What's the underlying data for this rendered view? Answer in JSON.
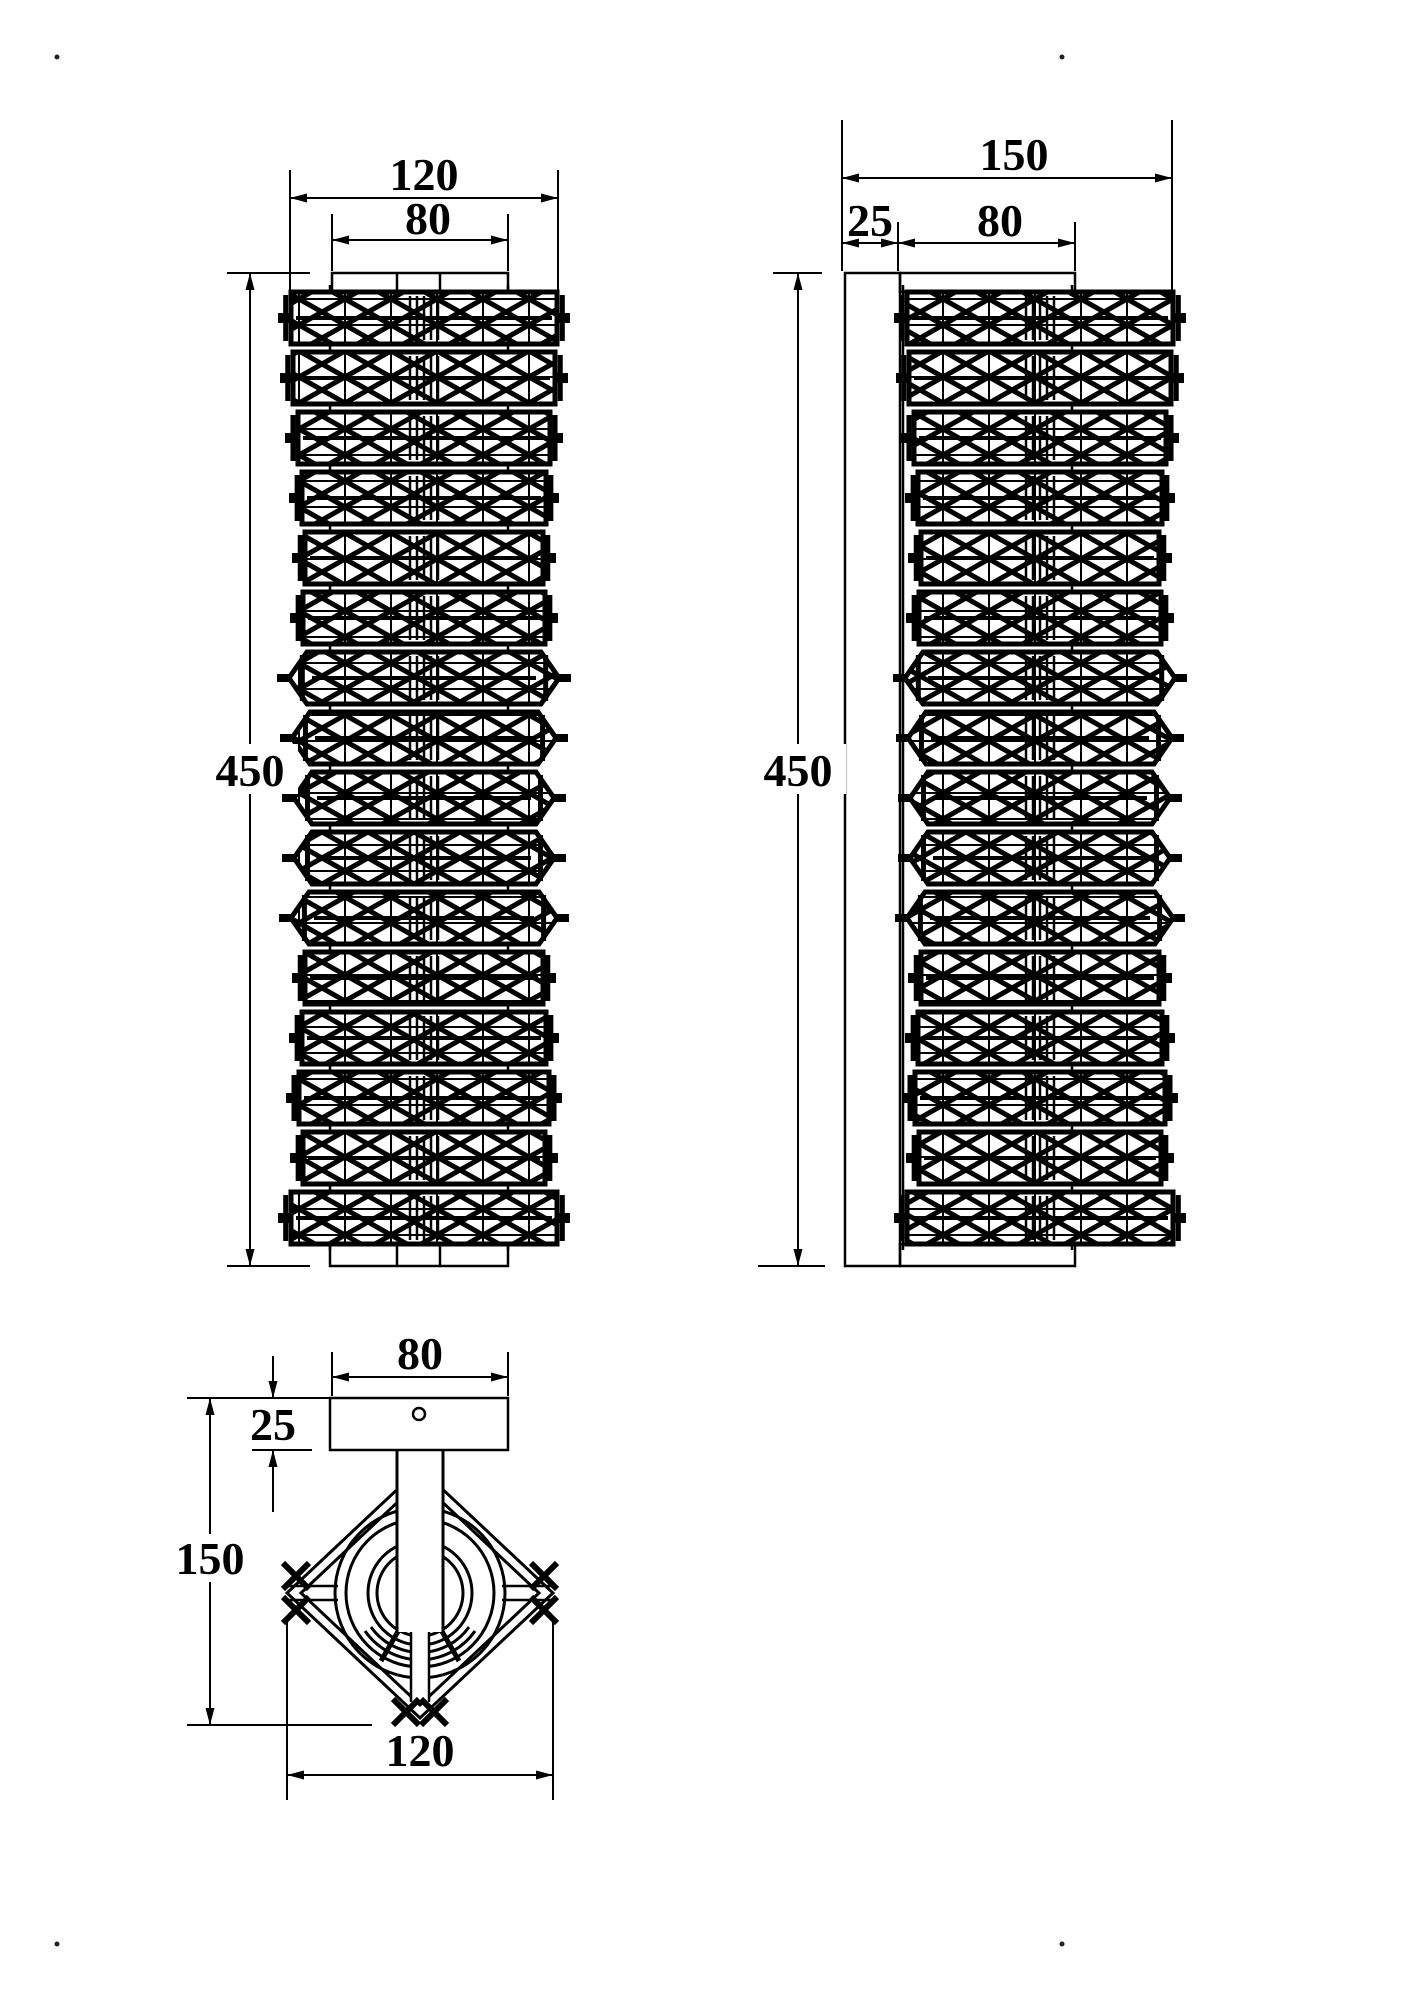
{
  "views": {
    "front": {
      "overall_width": "120",
      "canopy_width": "80",
      "height": "450"
    },
    "side": {
      "overall_depth": "150",
      "backplate_thickness": "25",
      "canopy_width": "80",
      "height": "450"
    },
    "top": {
      "canopy_width": "80",
      "canopy_depth": "25",
      "overall_depth": "150",
      "overall_width": "120"
    }
  },
  "colors": {
    "line": "#000000",
    "background": "#ffffff"
  }
}
